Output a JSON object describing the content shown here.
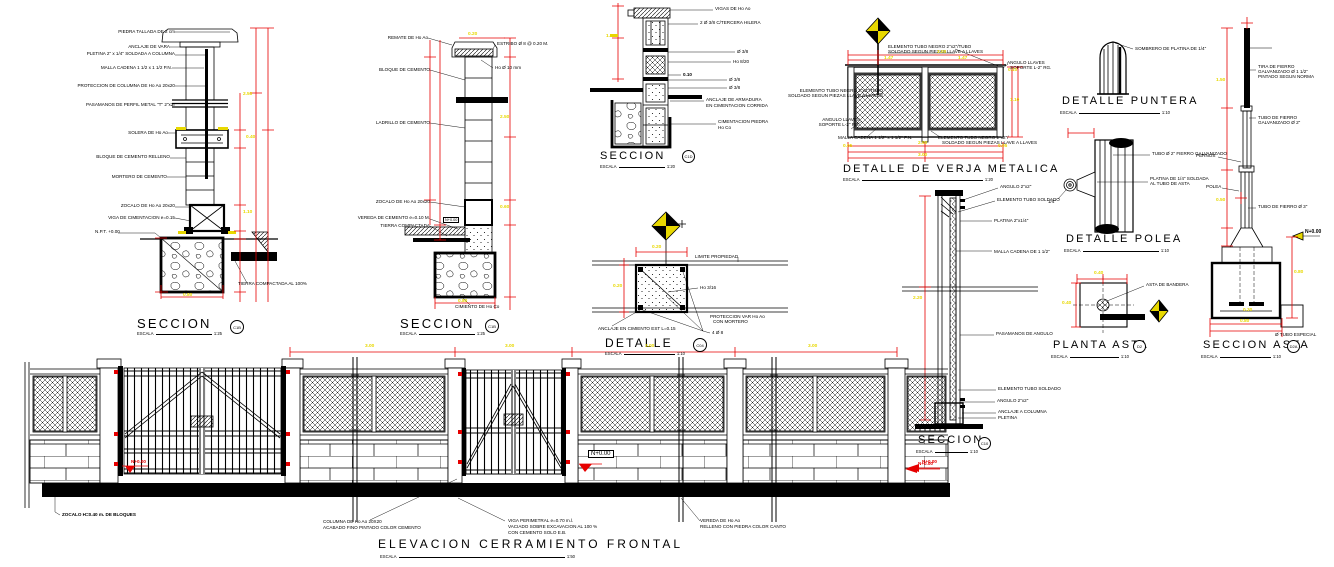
{
  "common": {
    "scale_label": "ESCALA"
  },
  "colors": {
    "line": "#000000",
    "dimension": "#e60000",
    "highlight": "#e8d800",
    "paper": "#ffffff"
  },
  "panels": {
    "seccion_a": {
      "title": "SECCION",
      "scale": "1:25",
      "bubble": "C1B",
      "labels": [
        "PIEDRA TALLADA DE 2 cm",
        "ANCLAJE DE VARA",
        "PLETINA 2\" x 1/4\" SOLDADA A COLUMNA",
        "MALLA CADENA 1 1/2 x 1 1/2 P.N.",
        "PROTECCION DE COLUMNA DE Ho Ao 20x20",
        "PASAMANOS DE PERFIL METAL \"T\" 2\"x2\"",
        "SOLERA DE Ho Ao",
        "BLOQUE DE CEMENTO RELLENO",
        "MORTERO DE CEMENTO",
        "ZOCALO DE Ho Ao 20x20",
        "VIGA DE CIMENTACION e=0.15",
        "N.P.T. +0.00",
        "TIERRA COMPACTADA AL 100%"
      ],
      "dims": [
        "2.50",
        "0.40",
        "1.10",
        "0.80"
      ]
    },
    "seccion_b": {
      "title": "SECCION",
      "scale": "1:25",
      "bubble": "C1B",
      "labels": [
        "REMATE DE Ho Ao",
        "ESTRIBO Ø 8 @ 0.20 M.",
        "Ho Ø 10 mm",
        "BLOQUE DE CEMENTO",
        "LADRILLO DE CEMENTO",
        "ZOCALO DE Ho Ao 20x20",
        "VEREDA DE CEMENTO e=0.10 M.",
        "TIERRA COMPACTADA",
        "N+0.00",
        "CIMIENTO DE Ho Co"
      ],
      "dims": [
        "0.20",
        "2.50",
        "0.60",
        "0.80"
      ]
    },
    "seccion_c": {
      "title": "SECCION",
      "scale": "1:20",
      "bubble": "C1D",
      "labels": [
        "VIGAS DE Ho Ao",
        "2 Ø 3/8 C/TERCERA HILERA",
        "Ø 3/8",
        "Ho 8/20",
        "0.10",
        "Ø 3/8",
        "Ø 3/8",
        "ANCLAJE DE ARMADURA",
        "EN CIMENTACION CORRIDA",
        "CIMENTACION PIEDRA",
        "Ho Co"
      ],
      "dims": [
        "1.10"
      ]
    },
    "detalle": {
      "title": "DETALLE",
      "scale": "1:10",
      "bubble": "C04",
      "labels": [
        "LIMITE PROPIEDAD",
        "Ho 3/16",
        "PROTECCION VAR Ho Ao",
        "CON MORTERO",
        "ANCLAJE EN CIMIENTO EST L=0.15",
        "4 Ø 8"
      ],
      "dims": [
        "0.20",
        "0.20"
      ]
    },
    "verja": {
      "title": "DETALLE  DE  VERJA  METALICA",
      "scale": "1:20",
      "labels": [
        "ELEMENTO TUBO NEGRO 2\"x2\"/TUBO",
        "SOLDADO SEGUN PIEZAS LLAVE A LLAVES",
        "ANGULO LLAVES",
        "SOPORTE L-2\" RG.",
        "ELEMENTO TUBO NEGRO 2\"x2\"/TUBO",
        "SOLDADO SEGUN PIEZAS LLAVE A LLAVES",
        "ANGULO LLAVES",
        "SOPORTE L-2\" RG.",
        "MALLA CADENA 1 1/2\" x 1 1/2\" P.N.",
        "ELEMENTO TUBO NEGRO 2\"x2\"/",
        "SOLDADO SEGUN PIEZAS LLAVE A LLAVES"
      ],
      "dims": [
        "3.00",
        "1.47",
        "1.47",
        "0.10",
        "1.10",
        "2.90",
        "3.00",
        "0.05",
        "0.05"
      ]
    },
    "puntera": {
      "title": "DETALLE  PUNTERA",
      "scale": "1:10",
      "labels": [
        "SOMBRERO DE PLATINA DE 1/4\""
      ]
    },
    "polea": {
      "title": "DETALLE  POLEA",
      "scale": "1:10",
      "labels": [
        "TUBO Ø 2\" FIERRO GALVANIZADO",
        "PLATINA DE 1/4\" SOLDADA",
        "AL TUBO DE ASTA",
        "1/4\""
      ]
    },
    "planta_asta": {
      "title": "PLANTA  ASTA",
      "scale": "1:10",
      "bubble": "D2",
      "labels": [
        "ASTA DE BANDERA"
      ],
      "dims": [
        "0.40",
        "0.40"
      ]
    },
    "seccion_asta": {
      "title": "SECCION  ASTA",
      "scale": "1:10",
      "bubble": "D2A",
      "labels": [
        "TIRA DE FIERRO",
        "GALVANIZADO Ø 1 1/2\"",
        "PINTADO SEGUN NORMA",
        "TUBO DE FIERRO",
        "GALVANIZADO Ø 2\"",
        "TUBO DE FIERRO Ø 3\"",
        "PERNOS",
        "POLEA",
        "N+0.00",
        "Ø TUBO ESPECIAL"
      ],
      "dims": [
        "1.50",
        "0.50",
        "0.80",
        "0.80",
        "0.30"
      ]
    },
    "seccion_fence": {
      "title": "SECCION",
      "scale": "1:10",
      "bubble": "C10",
      "level": "N+0.00",
      "labels": [
        "ANGULO 2\"x2\"",
        "ELEMENTO TUBO SOLDADO",
        "PLATINA 2\"x1/4\"",
        "MALLA CADENA DE 1 1/2\"",
        "PASAMANOS DE ANGULO",
        "ELEMENTO TUBO SOLDADO",
        "ANGULO 2\"x2\"",
        "ANCLAJE A COLUMNA",
        "PLETINA"
      ],
      "dims": [
        "2.20"
      ]
    },
    "elevacion": {
      "title": "ELEVACION  CERRAMIENTO  FRONTAL",
      "scale": "1:50",
      "labels": [
        "ZOCALO H=0.40 m. DE BLOQUES",
        "COLUMNA DE Ho Ao 20X20",
        "ACABADO FINO PINTADO COLOR CEMENTO",
        "VIGA PERIMETRAL e=0.70 m.l.",
        "VACIADO SOBRE EXCAVACION AL 100 %",
        "CON CEMENTO SOLO E.B.",
        "VEREDA DE Ho Ao",
        "RELLENO CON PIEDRA COLOR CANTO"
      ],
      "levels": [
        "N+0.00",
        "N+0.00",
        "N+0.00"
      ],
      "dims": [
        "3.00",
        "3.00",
        "3.00",
        "3.00"
      ]
    }
  }
}
